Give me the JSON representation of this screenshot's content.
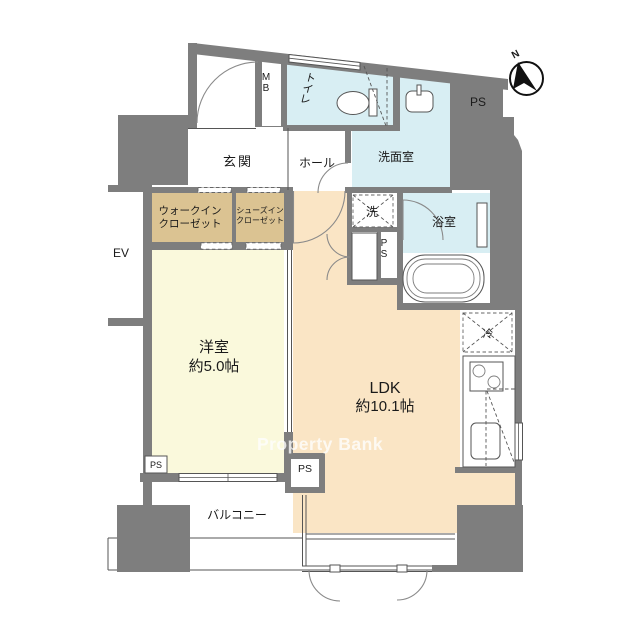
{
  "meta": {
    "type": "floor-plan",
    "watermark": "Property Bank",
    "compass_north": "N"
  },
  "rooms": {
    "genkan": "玄関",
    "hall": "ホール",
    "toilet": "トイレ",
    "washroom": "洗面室",
    "bath": "浴室",
    "laundry": "洗",
    "fridge": "冷",
    "wic_line1": "ウォークイン",
    "wic_line2": "クローゼット",
    "sic_line1": "シューズイン",
    "sic_line2": "クローゼット",
    "western_line1": "洋室",
    "western_line2": "約5.0帖",
    "ldk_line1": "LDK",
    "ldk_line2": "約10.1帖",
    "balcony": "バルコニー"
  },
  "labels": {
    "ps": "PS",
    "mb": "MB",
    "ev": "EV"
  },
  "colors": {
    "wall": "#7E7E7E",
    "water_room": "#D8EEF3",
    "ldk_floor": "#FAE5C5",
    "western_floor": "#FAF9DC",
    "closet_floor": "#DBC392",
    "line": "#555555",
    "text": "#1A1A1A",
    "watermark_text": "#FFFFFF"
  }
}
